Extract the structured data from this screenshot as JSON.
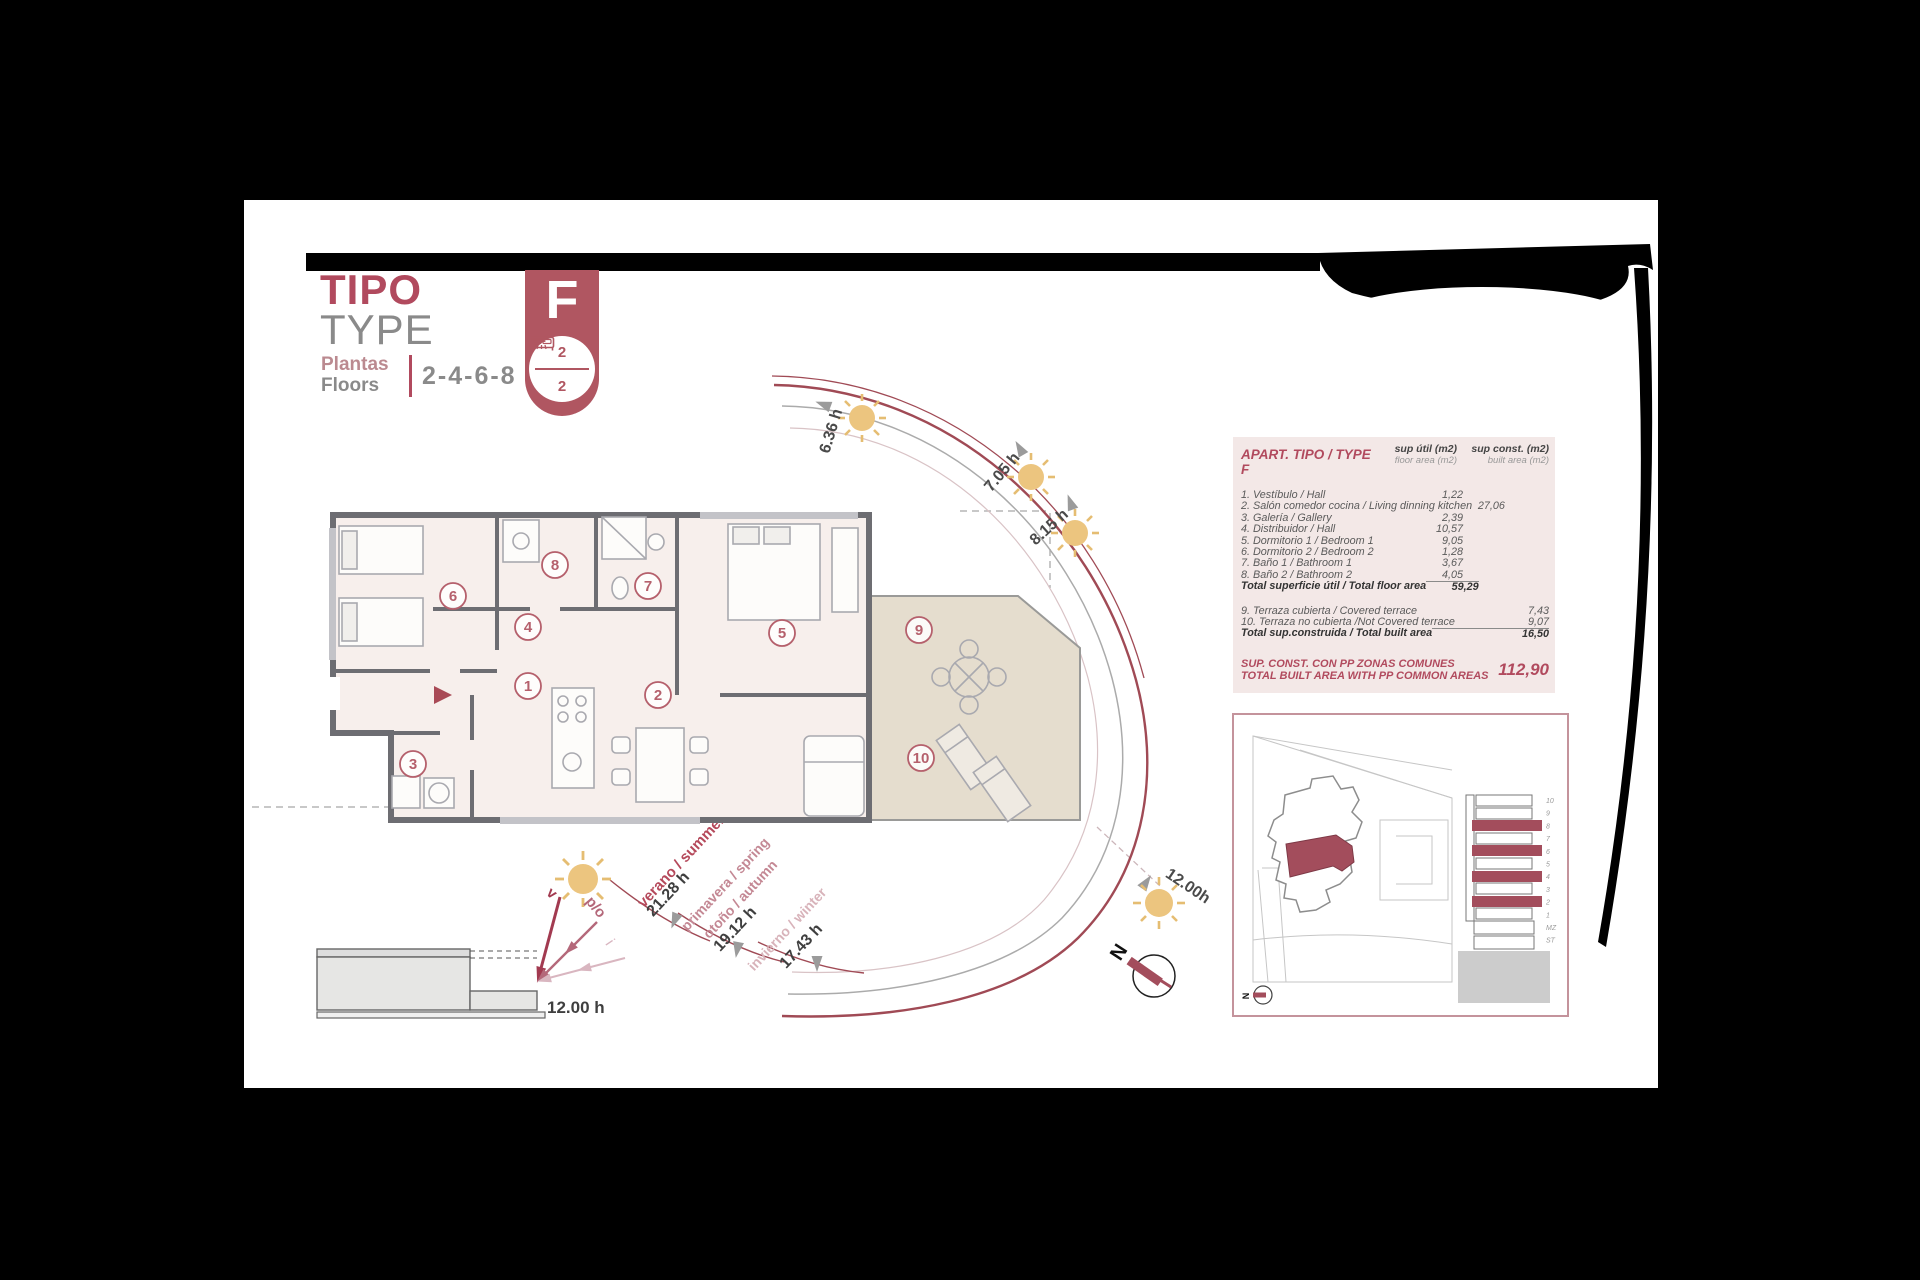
{
  "header": {
    "title_primary": "TIPO",
    "title_secondary": "TYPE",
    "floors_label_es": "Plantas",
    "floors_label_en": "Floors",
    "floors_value": "2-4-6-8",
    "badge_letter": "F",
    "badge_bedrooms": "2",
    "badge_bathrooms": "2"
  },
  "table": {
    "title": "APART. TIPO / TYPE F",
    "col1_title": "sup útil (m2)",
    "col1_sub": "floor area (m2)",
    "col2_title": "sup const. (m2)",
    "col2_sub": "built area (m2)",
    "rows": [
      {
        "label": "1. Vestíbulo / Hall",
        "util": "1,22",
        "const": ""
      },
      {
        "label": "2. Salón comedor cocina / Living dinning kitchen",
        "util": "27,06",
        "const": ""
      },
      {
        "label": "3. Galería / Gallery",
        "util": "2,39",
        "const": ""
      },
      {
        "label": "4. Distribuidor / Hall",
        "util": "10,57",
        "const": ""
      },
      {
        "label": "5. Dormitorio 1 / Bedroom 1",
        "util": "9,05",
        "const": ""
      },
      {
        "label": "6. Dormitorio 2 / Bedroom 2",
        "util": "1,28",
        "const": ""
      },
      {
        "label": "7. Baño 1 / Bathroom 1",
        "util": "3,67",
        "const": ""
      },
      {
        "label": "8. Baño 2 / Bathroom 2",
        "util": "4,05",
        "const": ""
      },
      {
        "label": "9. Terraza cubierta / Covered terrace",
        "util": "",
        "const": "7,43"
      },
      {
        "label": "10. Terraza no cubierta /Not Covered terrace",
        "util": "",
        "const": "9,07"
      }
    ],
    "total_util_label": "Total superficie útil / Total floor area",
    "total_util": "59,29",
    "total_const_label": "Total sup.construida / Total built area",
    "total_const": "16,50",
    "common_label_es": "SUP. CONST. CON PP ZONAS COMUNES",
    "common_label_en": "TOTAL BUILT AREA WITH PP COMMON AREAS",
    "common_value": "112,90"
  },
  "plan": {
    "room_numbers": [
      "1",
      "2",
      "3",
      "4",
      "5",
      "6",
      "7",
      "8",
      "9",
      "10"
    ]
  },
  "sun_path": {
    "times": [
      {
        "label": "6.36 h"
      },
      {
        "label": "7.05 h"
      },
      {
        "label": "8.15 h"
      },
      {
        "label": "12.00h"
      }
    ],
    "seasons": [
      {
        "name": "verano / summer",
        "time": "21.28 h"
      },
      {
        "name_line1": "primavera / spring",
        "name_line2": "otoño / autumn",
        "time": "19.12 h"
      },
      {
        "name": "invierno / winter",
        "time": "17.43 h"
      }
    ]
  },
  "section_diagram": {
    "time_label": "12.00 h",
    "arrow_v": "v",
    "arrow_po": "p/o",
    "arrow_i": "i"
  },
  "compass": {
    "north_label": "N"
  },
  "site_plan": {
    "north_label": "N",
    "floor_labels": [
      "10",
      "9",
      "8",
      "7",
      "6",
      "5",
      "4",
      "3",
      "2",
      "1",
      "MZ",
      "ST"
    ]
  }
}
